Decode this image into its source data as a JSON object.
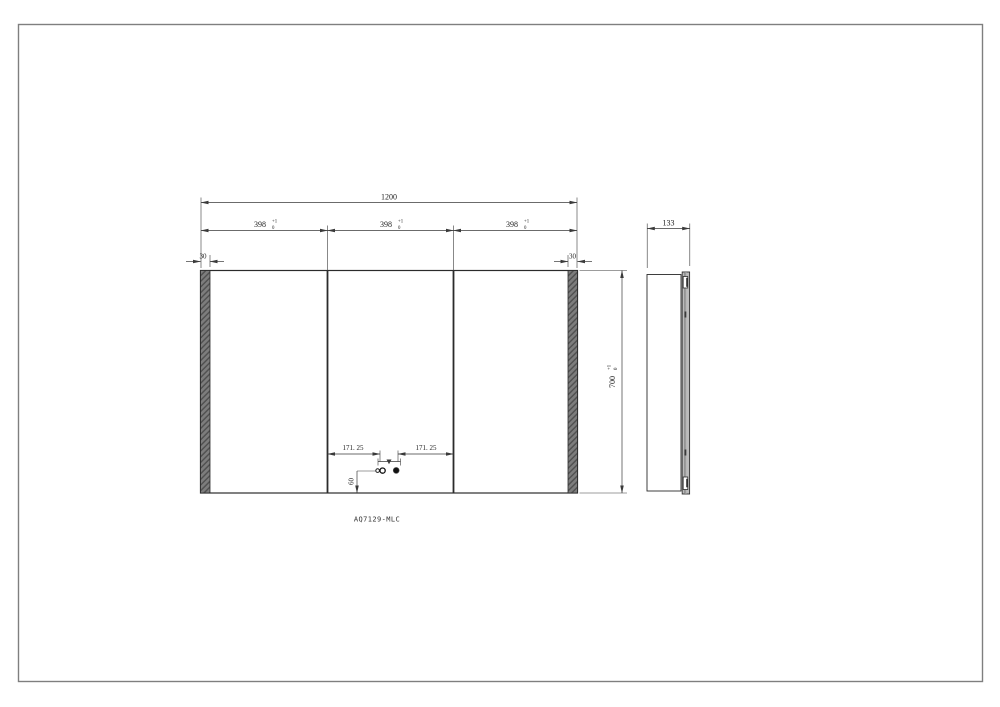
{
  "page": {
    "background": "#ffffff",
    "frame_color": "#7f7f7f"
  },
  "drawing": {
    "model_label": "AQ7129-MLC",
    "colors": {
      "line": "#2b2b2b",
      "dim": "#3a3a3a",
      "dim_text": "#222222",
      "hatch_base": "#7d7d7d",
      "hatch_line": "#4f4f4f",
      "door_fill": "#e3e3e3",
      "door_core": "#9b9b9b"
    },
    "front_view": {
      "overall_width": "1200",
      "sections": [
        {
          "value": "398",
          "tol_upper": "+1",
          "tol_lower": "0"
        },
        {
          "value": "398",
          "tol_upper": "+1",
          "tol_lower": "0"
        },
        {
          "value": "398",
          "tol_upper": "+1",
          "tol_lower": "0"
        }
      ],
      "edge_left": "30",
      "edge_right": "30",
      "overall_height": {
        "value": "700",
        "tol_upper": "+1",
        "tol_lower": "0"
      },
      "hole_offset_left": "171. 25",
      "hole_offset_right": "171. 25",
      "hole_height": "60"
    },
    "side_view": {
      "depth": "133"
    }
  }
}
